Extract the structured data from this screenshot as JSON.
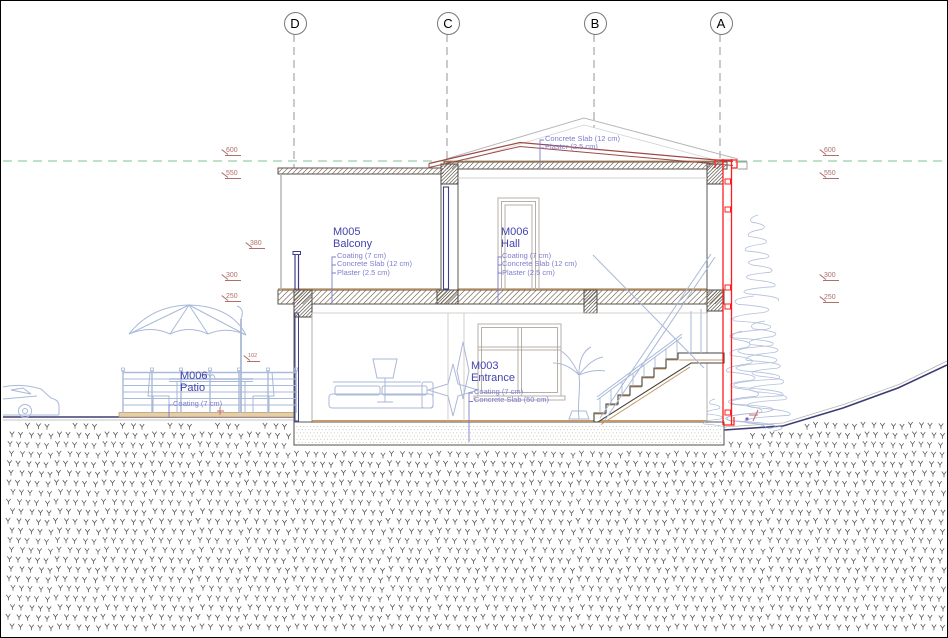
{
  "grid": {
    "axes": [
      {
        "label": "D"
      },
      {
        "label": "C"
      },
      {
        "label": "B"
      },
      {
        "label": "A"
      }
    ]
  },
  "callouts": {
    "roof": {
      "lines": [
        "Concrete Slab (12 cm)",
        "Plaster (2.5 cm)"
      ]
    },
    "balcony": {
      "id": "M005",
      "name": "Balcony",
      "materials": [
        "Coating (7 cm)",
        "Concrete Slab (12 cm)",
        "Plaster (2.5 cm)"
      ]
    },
    "hall": {
      "id": "M006",
      "name": "Hall",
      "materials": [
        "Coating (7 cm)",
        "Concrete Slab (12 cm)",
        "Plaster (2.5 cm)"
      ]
    },
    "entrance": {
      "id": "M003",
      "name": "Entrance",
      "materials": [
        "Coating (7 cm)",
        "Concrete Slab (50 cm)"
      ]
    },
    "patio": {
      "id": "M006",
      "name": "Patio",
      "materials": [
        "Coating (7 cm)"
      ]
    }
  },
  "levels": {
    "left": [
      "600",
      "550",
      "380",
      "300",
      "250"
    ],
    "right": [
      "600",
      "550",
      "300",
      "250"
    ],
    "patio_dim": "102"
  },
  "colors": {
    "selection_red": "#ff1c1c",
    "roof_red": "#9c4a45",
    "annotation_blue": "#4343ae",
    "material_blue": "#7d7dcf",
    "level_red": "#b06f6d",
    "datum_green": "#7cc68f",
    "ground_navy": "#3d3d73",
    "earth_mark": "#3f3f3f",
    "tan": "#c59a6b",
    "entourage_blue": "#a9b9d8",
    "line_dark": "#55504a",
    "grid_gray": "#8a8a8a"
  }
}
